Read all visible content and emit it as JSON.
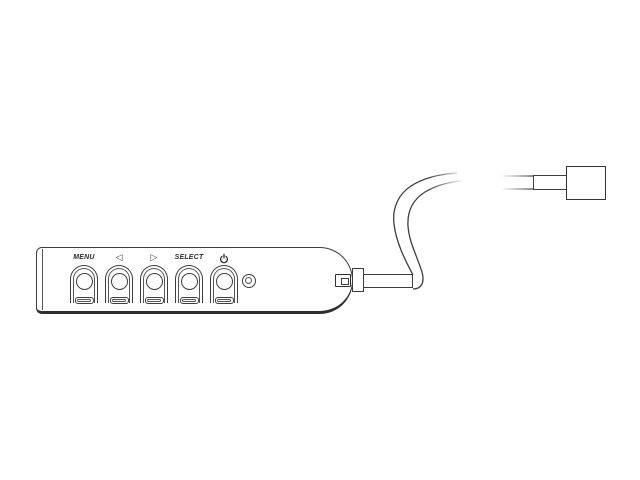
{
  "figure": {
    "background": "#ffffff",
    "line_color": "#3e3e3e",
    "description": "Black-and-white line drawing of a wired remote control pad with five buttons and an LED, connected by an S-curved cable to a rectangular plug"
  },
  "remote": {
    "buttons": [
      {
        "label": "MENU"
      },
      {
        "label": "◁"
      },
      {
        "label": "▷"
      },
      {
        "label": "SELECT"
      },
      {
        "label": "⏻",
        "icon": "power-icon"
      }
    ],
    "indicator": "led",
    "accent": "#2f2f2f"
  }
}
